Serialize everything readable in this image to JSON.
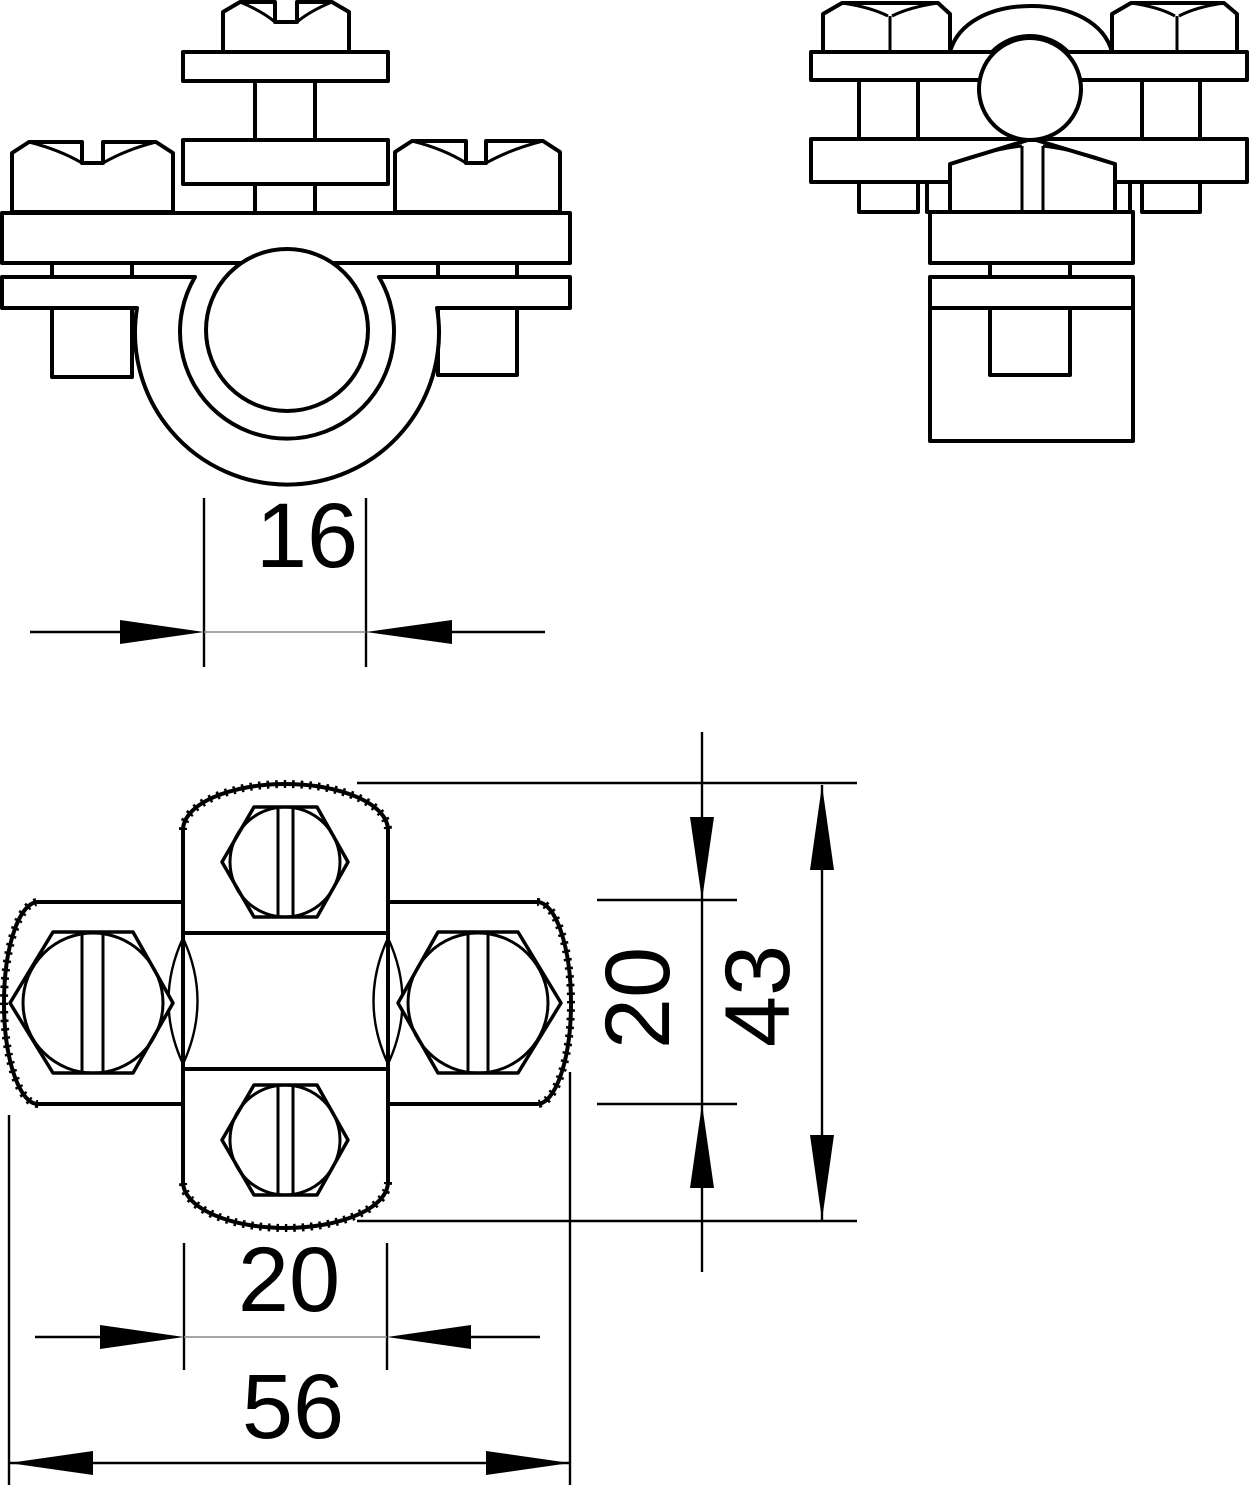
{
  "drawing": {
    "type": "technical-orthographic-views",
    "background_color": "#ffffff",
    "line_color": "#000000",
    "views": {
      "front": "front-view-clamp-with-round-conductor",
      "side": "side-view-clamp",
      "plan": "plan-view-cross-clamp"
    },
    "dims": {
      "rod_diameter": "16",
      "cross_bar_width": "20",
      "body_length": "43",
      "bar_width": "20",
      "overall_width": "56"
    }
  }
}
